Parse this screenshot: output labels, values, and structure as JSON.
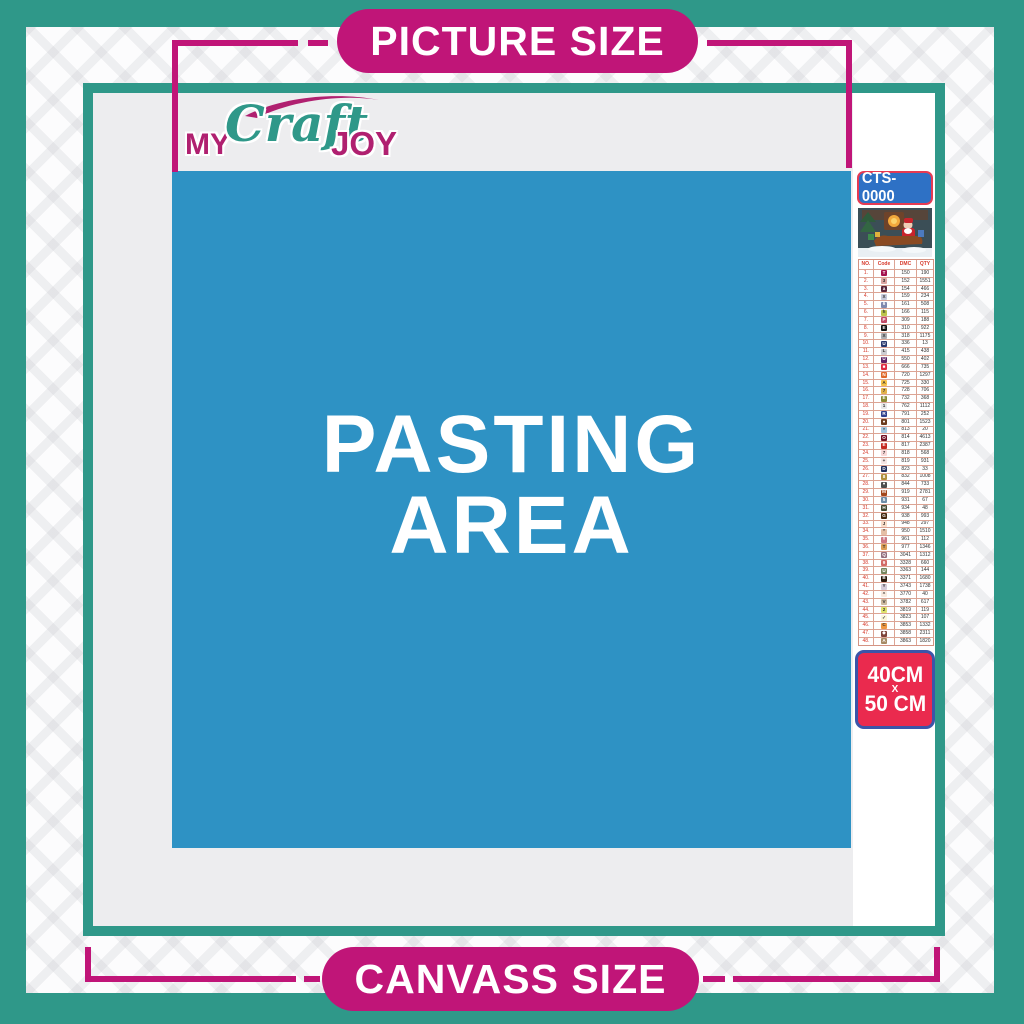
{
  "banners": {
    "top": "PICTURE SIZE",
    "bottom": "CANVASS SIZE"
  },
  "logo": {
    "my": "MY",
    "craft": "Craft",
    "joy": "JOY"
  },
  "pasting_area": {
    "line1": "PASTING",
    "line2": "AREA"
  },
  "side_panel": {
    "code": "CTS-0000",
    "thumbnail": "christmas-santa-sleigh-scene",
    "table": {
      "headers": [
        "NO.",
        "Code",
        "DMC",
        "QTY"
      ],
      "rows": [
        {
          "no": "1.",
          "sym": "T",
          "bg": "#A3124E",
          "fg": "#FFFFFF",
          "dmc": "150",
          "qty": "190"
        },
        {
          "no": "2.",
          "sym": "3",
          "bg": "#DCA6A2",
          "fg": "#333333",
          "dmc": "152",
          "qty": "1551"
        },
        {
          "no": "3.",
          "sym": "a",
          "bg": "#57253B",
          "fg": "#FFFFFF",
          "dmc": "154",
          "qty": "466"
        },
        {
          "no": "4.",
          "sym": "X",
          "bg": "#C4C8DA",
          "fg": "#333333",
          "dmc": "159",
          "qty": "234"
        },
        {
          "no": "5.",
          "sym": "6",
          "bg": "#8089AE",
          "fg": "#FFFFFF",
          "dmc": "161",
          "qty": "508"
        },
        {
          "no": "6.",
          "sym": "h",
          "bg": "#BDC44B",
          "fg": "#333333",
          "dmc": "166",
          "qty": "115"
        },
        {
          "no": "7.",
          "sym": "P",
          "bg": "#C04A66",
          "fg": "#FFFFFF",
          "dmc": "309",
          "qty": "188"
        },
        {
          "no": "8.",
          "sym": "E",
          "bg": "#111111",
          "fg": "#FFFFFF",
          "dmc": "310",
          "qty": "922"
        },
        {
          "no": "9.",
          "sym": "X",
          "bg": "#ACACB0",
          "fg": "#333333",
          "dmc": "318",
          "qty": "1175"
        },
        {
          "no": "10.",
          "sym": "U",
          "bg": "#27386E",
          "fg": "#FFFFFF",
          "dmc": "336",
          "qty": "13"
        },
        {
          "no": "11.",
          "sym": "L",
          "bg": "#CDCDD2",
          "fg": "#333333",
          "dmc": "415",
          "qty": "438"
        },
        {
          "no": "12.",
          "sym": "U",
          "bg": "#5E2165",
          "fg": "#FFFFFF",
          "dmc": "550",
          "qty": "402"
        },
        {
          "no": "13.",
          "sym": "■",
          "bg": "#DE2B42",
          "fg": "#FFFFFF",
          "dmc": "666",
          "qty": "735"
        },
        {
          "no": "14.",
          "sym": "N",
          "bg": "#E06A2C",
          "fg": "#FFFFFF",
          "dmc": "720",
          "qty": "1297"
        },
        {
          "no": "15.",
          "sym": "A",
          "bg": "#F6C24A",
          "fg": "#333333",
          "dmc": "725",
          "qty": "330"
        },
        {
          "no": "16.",
          "sym": "7",
          "bg": "#E3B24B",
          "fg": "#333333",
          "dmc": "728",
          "qty": "706"
        },
        {
          "no": "17.",
          "sym": "E",
          "bg": "#8A8A33",
          "fg": "#FFFFFF",
          "dmc": "732",
          "qty": "368"
        },
        {
          "no": "18.",
          "sym": "1",
          "bg": "#E6E6E8",
          "fg": "#333333",
          "dmc": "762",
          "qty": "1112"
        },
        {
          "no": "19.",
          "sym": "R",
          "bg": "#31418F",
          "fg": "#FFFFFF",
          "dmc": "791",
          "qty": "252"
        },
        {
          "no": "20.",
          "sym": "●",
          "bg": "#6A3B1D",
          "fg": "#FFFFFF",
          "dmc": "801",
          "qty": "1523"
        },
        {
          "no": "21.",
          "sym": "*",
          "bg": "#9FC6DF",
          "fg": "#333333",
          "dmc": "813",
          "qty": "20"
        },
        {
          "no": "22.",
          "sym": "O",
          "bg": "#731224",
          "fg": "#FFFFFF",
          "dmc": "814",
          "qty": "4613"
        },
        {
          "no": "23.",
          "sym": "E",
          "bg": "#C52A20",
          "fg": "#FFFFFF",
          "dmc": "817",
          "qty": "2387"
        },
        {
          "no": "24.",
          "sym": "7",
          "bg": "#F8D8D8",
          "fg": "#333333",
          "dmc": "818",
          "qty": "568"
        },
        {
          "no": "25.",
          "sym": "+",
          "bg": "#F6E6E4",
          "fg": "#333333",
          "dmc": "819",
          "qty": "931"
        },
        {
          "no": "26.",
          "sym": "D",
          "bg": "#1F2E5C",
          "fg": "#FFFFFF",
          "dmc": "823",
          "qty": "33"
        },
        {
          "no": "27.",
          "sym": "8",
          "bg": "#B08F3E",
          "fg": "#FFFFFF",
          "dmc": "832",
          "qty": "1008"
        },
        {
          "no": "28.",
          "sym": "●",
          "bg": "#4E4E4E",
          "fg": "#FFFFFF",
          "dmc": "844",
          "qty": "733"
        },
        {
          "no": "29.",
          "sym": "M",
          "bg": "#A2471D",
          "fg": "#FFFFFF",
          "dmc": "919",
          "qty": "2781"
        },
        {
          "no": "30.",
          "sym": "5",
          "bg": "#6E8CA6",
          "fg": "#FFFFFF",
          "dmc": "931",
          "qty": "67"
        },
        {
          "no": "31.",
          "sym": "H",
          "bg": "#43472F",
          "fg": "#FFFFFF",
          "dmc": "934",
          "qty": "48"
        },
        {
          "no": "32.",
          "sym": "G",
          "bg": "#46280F",
          "fg": "#FFFFFF",
          "dmc": "938",
          "qty": "993"
        },
        {
          "no": "33.",
          "sym": "J",
          "bg": "#F9DCC8",
          "fg": "#333333",
          "dmc": "948",
          "qty": "297"
        },
        {
          "no": "34.",
          "sym": "*",
          "bg": "#E5BFA6",
          "fg": "#333333",
          "dmc": "950",
          "qty": "1510"
        },
        {
          "no": "35.",
          "sym": "#",
          "bg": "#CC7581",
          "fg": "#FFFFFF",
          "dmc": "961",
          "qty": "112"
        },
        {
          "no": "36.",
          "sym": "T",
          "bg": "#DB9C55",
          "fg": "#333333",
          "dmc": "977",
          "qty": "1346"
        },
        {
          "no": "37.",
          "sym": "Q",
          "bg": "#95707F",
          "fg": "#FFFFFF",
          "dmc": "3041",
          "qty": "1312"
        },
        {
          "no": "38.",
          "sym": "9",
          "bg": "#D26A66",
          "fg": "#FFFFFF",
          "dmc": "3328",
          "qty": "660"
        },
        {
          "no": "39.",
          "sym": "U",
          "bg": "#75855C",
          "fg": "#FFFFFF",
          "dmc": "3363",
          "qty": "144"
        },
        {
          "no": "40.",
          "sym": "B",
          "bg": "#2A190B",
          "fg": "#FFFFFF",
          "dmc": "3371",
          "qty": "1680"
        },
        {
          "no": "41.",
          "sym": "Y",
          "bg": "#D4CBD8",
          "fg": "#333333",
          "dmc": "3743",
          "qty": "1738"
        },
        {
          "no": "42.",
          "sym": "^",
          "bg": "#F8EADF",
          "fg": "#333333",
          "dmc": "3770",
          "qty": "40"
        },
        {
          "no": "43.",
          "sym": "V",
          "bg": "#CDB99F",
          "fg": "#333333",
          "dmc": "3782",
          "qty": "617"
        },
        {
          "no": "44.",
          "sym": "2",
          "bg": "#DFE36D",
          "fg": "#333333",
          "dmc": "3819",
          "qty": "119"
        },
        {
          "no": "45.",
          "sym": "✓",
          "bg": "#FBF6DA",
          "fg": "#333333",
          "dmc": "3823",
          "qty": "107"
        },
        {
          "no": "46.",
          "sym": "C",
          "bg": "#EF9742",
          "fg": "#333333",
          "dmc": "3853",
          "qty": "1332"
        },
        {
          "no": "47.",
          "sym": "◆",
          "bg": "#7E4338",
          "fg": "#FFFFFF",
          "dmc": "3858",
          "qty": "2311"
        },
        {
          "no": "48.",
          "sym": "A",
          "bg": "#A68A64",
          "fg": "#FFFFFF",
          "dmc": "3863",
          "qty": "1820"
        }
      ]
    },
    "size": {
      "line1": "40CM",
      "line2": "X",
      "line3": "50 CM"
    }
  },
  "colors": {
    "teal": "#2F9889",
    "magenta": "#C01578",
    "pasting_blue": "#2E92C4",
    "size_box_red": "#EA2A4E",
    "size_box_border": "#3B55A9",
    "badge_blue": "#2E71C5",
    "badge_border_red": "#E63A52"
  }
}
